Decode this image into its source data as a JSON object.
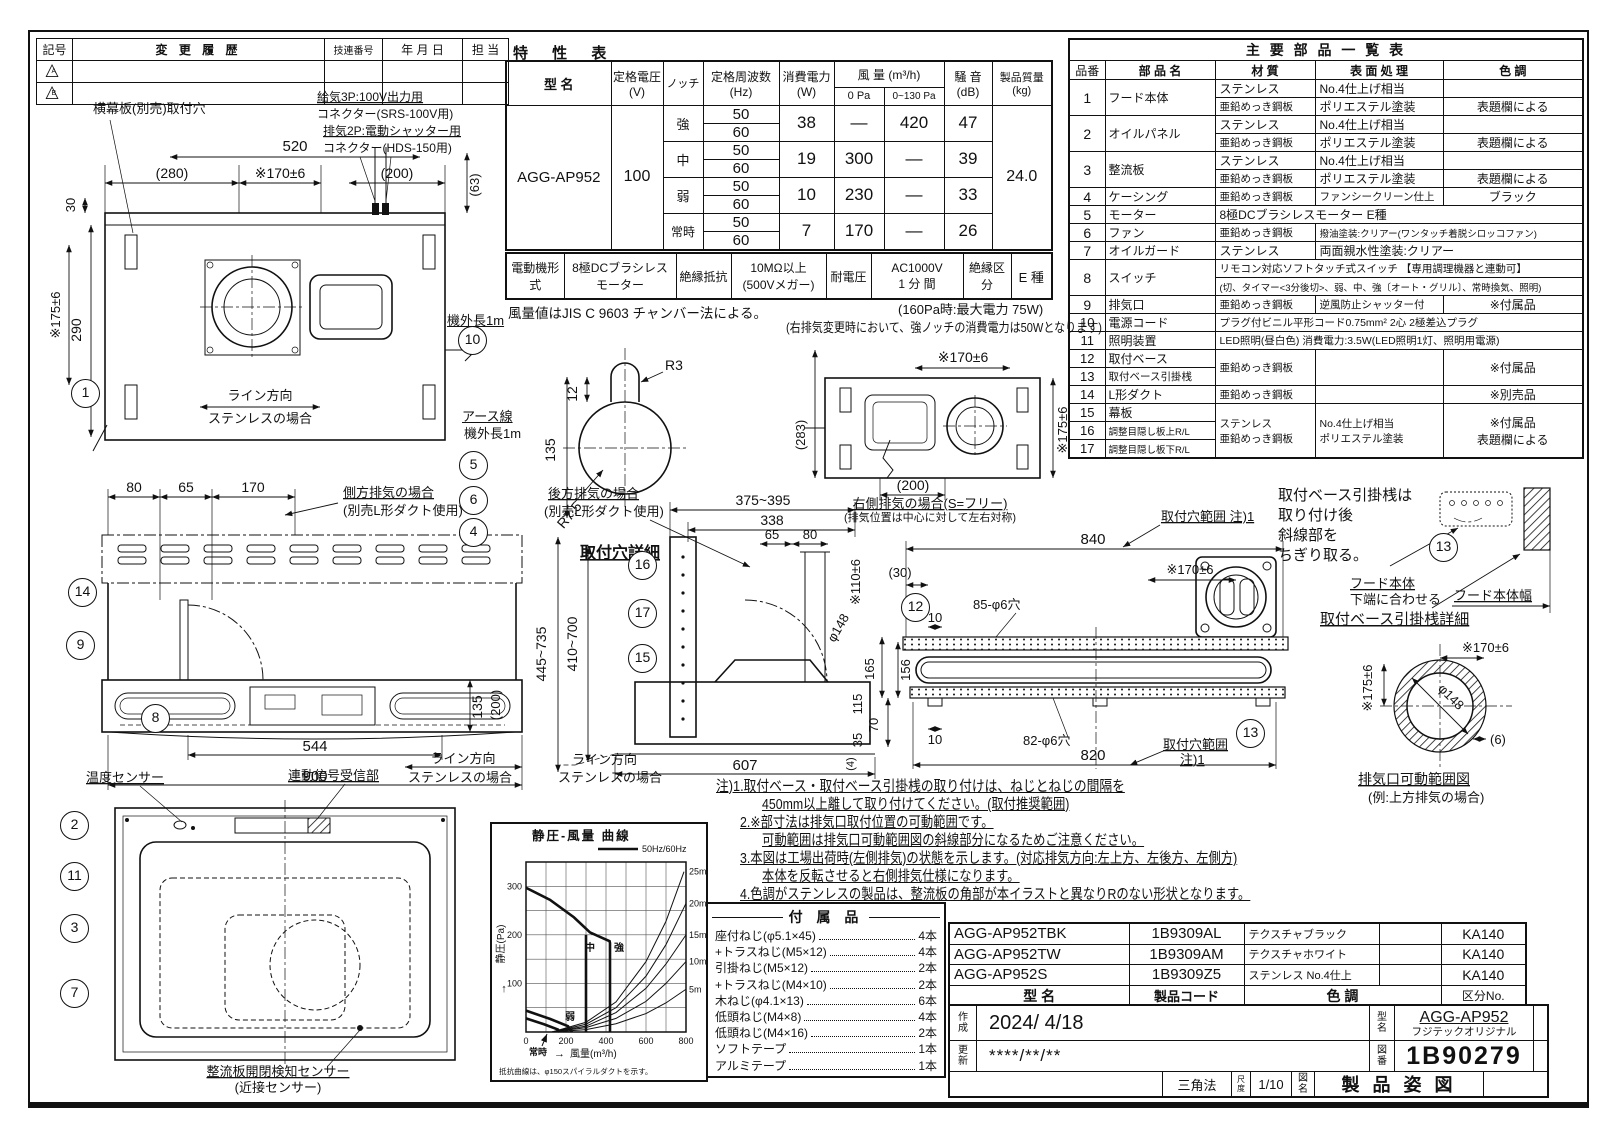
{
  "revision": {
    "headers": [
      "記号",
      "変 更 履 歴",
      "技連番号",
      "年 月 日",
      "担 当"
    ],
    "marks": [
      "A",
      "B"
    ]
  },
  "spec": {
    "title": "特   性   表",
    "h_model": "型   名",
    "h_voltage": "定格電圧\n(V)",
    "h_notch": "ノッチ",
    "h_freq": "定格周波数\n(Hz)",
    "h_power": "消費電力\n(W)",
    "h_airflow": "風 量 (m³/h)",
    "h_airflow_0": "0 Pa",
    "h_airflow_130": "0~130 Pa",
    "h_noise": "騒 音\n(dB)",
    "h_mass": "製品質量\n(kg)",
    "model": "AGG-AP952",
    "voltage": "100",
    "mass": "24.0",
    "rows": [
      {
        "notch": "強",
        "f1": "50",
        "f2": "60",
        "power": "38",
        "q0": "—",
        "q130": "420",
        "noise": "47"
      },
      {
        "notch": "中",
        "f1": "50",
        "f2": "60",
        "power": "19",
        "q0": "300",
        "q130": "—",
        "noise": "39"
      },
      {
        "notch": "弱",
        "f1": "50",
        "f2": "60",
        "power": "10",
        "q0": "230",
        "q130": "—",
        "noise": "33"
      },
      {
        "notch": "常時",
        "f1": "50",
        "f2": "60",
        "power": "7",
        "q0": "170",
        "q130": "—",
        "noise": "26"
      }
    ],
    "motor_row": [
      "電動機形式",
      "8極DCブラシレス\nモーター",
      "絶縁抵抗",
      "10MΩ以上\n(500Vメガー)",
      "耐電圧",
      "AC1000V\n1 分 間",
      "絶縁区分",
      "E 種"
    ],
    "note1": "風量値はJIS C 9603 チャンバー法による。",
    "note2": "(160Pa時:最大電力 75W)",
    "note3": "(右排気変更時において、強ノッチの消費電力は50Wとなります)"
  },
  "parts": {
    "title": "主  要  部  品  一  覧  表",
    "h": [
      "品番",
      "部 品 名",
      "材   質",
      "表 面 処 理",
      "色   調"
    ],
    "r1": {
      "no": "1",
      "name": "フード本体",
      "m1": "ステンレス",
      "t1": "No.4仕上げ相当",
      "c1": "",
      "m2": "亜鉛めっき鋼板",
      "t2": "ポリエステル塗装",
      "c2": "表題欄による"
    },
    "r2": {
      "no": "2",
      "name": "オイルパネル",
      "m1": "ステンレス",
      "t1": "No.4仕上げ相当",
      "c1": "",
      "m2": "亜鉛めっき鋼板",
      "t2": "ポリエステル塗装",
      "c2": "表題欄による"
    },
    "r3": {
      "no": "3",
      "name": "整流板",
      "m1": "ステンレス",
      "t1": "No.4仕上げ相当",
      "c1": "",
      "m2": "亜鉛めっき鋼板",
      "t2": "ポリエステル塗装",
      "c2": "表題欄による"
    },
    "r4": {
      "no": "4",
      "name": "ケーシング",
      "m": "亜鉛めっき鋼板",
      "t": "ファンシークリーン仕上",
      "c": "ブラック"
    },
    "r5": {
      "no": "5",
      "name": "モーター",
      "full": "8極DCブラシレスモーター E種"
    },
    "r6": {
      "no": "6",
      "name": "ファン",
      "m": "亜鉛めっき鋼板",
      "t": "撥油塗装:クリアー(ワンタッチ着脱シロッコファン)"
    },
    "r7": {
      "no": "7",
      "name": "オイルガード",
      "m": "ステンレス",
      "t": "両面親水性塗装:クリアー"
    },
    "r8": {
      "no": "8",
      "name": "スイッチ",
      "l1": "リモコン対応ソフトタッチ式スイッチ 【専用調理機器と連動可】",
      "l2": "(切、タイマー<3分後切>、弱、中、強〔オート・グリル〕、常時換気、照明)"
    },
    "r9": {
      "no": "9",
      "name": "排気口",
      "m": "亜鉛めっき鋼板",
      "t": "逆風防止シャッター付",
      "c": "※付属品"
    },
    "r10": {
      "no": "10",
      "name": "電源コード",
      "full": "プラグ付ビニル平形コード0.75mm² 2心 2極差込プラグ"
    },
    "r11": {
      "no": "11",
      "name": "照明装置",
      "full": "LED照明(昼白色) 消費電力:3.5W(LED照明1灯、照明用電源)"
    },
    "r12": {
      "no": "12",
      "name": "取付ベース"
    },
    "r13": {
      "no": "13",
      "name": "取付ベース引掛桟"
    },
    "g1213": {
      "m": "亜鉛めっき鋼板",
      "c": "※付属品"
    },
    "r14": {
      "no": "14",
      "name": "L形ダクト",
      "m": "亜鉛めっき鋼板",
      "c": "※別売品"
    },
    "r15": {
      "no": "15",
      "name": "幕板"
    },
    "r16": {
      "no": "16",
      "name": "調整目隠し板上R/L"
    },
    "r17": {
      "no": "17",
      "name": "調整目隠し板下R/L"
    },
    "g1517": {
      "m": "ステンレス\n亜鉛めっき鋼板",
      "t": "No.4仕上げ相当\nポリエステル塗装",
      "c": "※付属品\n表題欄による"
    }
  },
  "dw": {
    "top": {
      "hole_label": "横幕板(別売)取付穴",
      "conn1": "給気3P:100V出力用",
      "conn2": "コネクター(SRS-100V用)",
      "conn3": "排気2P:電動シャッター用",
      "conn4": "コネクター(HDS-150用)",
      "d520": "520",
      "d280": "(280)",
      "d170": "※170±6",
      "d200": "(200)",
      "d63": "(63)",
      "d30": "30",
      "d290": "290",
      "d175": "※175±6",
      "line1": "ライン方向",
      "line2": "ステンレスの場合",
      "cord": "機外長1m",
      "earth": "アース線",
      "earth_len": "機外長1m"
    },
    "keyhole": {
      "r3": "R3",
      "d12": "12",
      "d135": "135",
      "r75": "R7.5",
      "cap": "取付穴詳細"
    },
    "front": {
      "d80": "80",
      "d65": "65",
      "d170": "170",
      "side1": "側方排気の場合",
      "side2": "(別売L形ダクト使用)",
      "d544": "544",
      "d900": "900",
      "d135": "135",
      "d200": "(200)",
      "line1": "ライン方向",
      "line2": "ステンレスの場合"
    },
    "bottom": {
      "temp": "温度センサー",
      "recv": "連動信号受信部",
      "sens1": "整流板開閉検知センサー",
      "sens2": "(近接センサー)"
    },
    "side": {
      "rear1": "後方排気の場合",
      "rear2": "(別売L形ダクト使用)",
      "d375": "375~395",
      "d338": "338",
      "d65": "65",
      "d80": "80",
      "d110": "※110±6",
      "d148": "φ148",
      "d445": "445~735",
      "d410": "410~700",
      "d607": "607",
      "d115": "115",
      "d35": "35",
      "d4": "(4)",
      "line1": "ライン方向",
      "line2": "ステンレスの場合"
    },
    "rtop": {
      "d170": "※170±6",
      "d283": "(283)",
      "d200": "(200)",
      "d175": "※175±6",
      "cap1": "右側排気の場合(S=フリー)",
      "cap2": "(排気位置は中心に対して左右対称)"
    },
    "rbottom": {
      "range1": "取付穴範囲 注)1",
      "d840": "840",
      "d30": "(30)",
      "d170": "※170±6",
      "h85": "85-φ6穴",
      "d10a": "10",
      "d165": "165",
      "d156": "156",
      "d70": "70",
      "d10b": "10",
      "h82": "82-φ6穴",
      "d820": "820",
      "range2": "取付穴範囲",
      "range3": "注)1"
    },
    "detail": {
      "n1": "取付ベース引掛桟は",
      "n2": "取り付け後",
      "n3": "斜線部を",
      "n4": "ちぎり取る。",
      "hood1": "フード本体",
      "hood2": "下端に合わせる",
      "hoodw": "フード本体幅",
      "cap": "取付ベース引掛桟詳細",
      "d175": "※175±6",
      "d170": "※170±6",
      "d148": "φ148",
      "d6": "(6)",
      "cap2": "排気口可動範囲図",
      "cap3": "(例:上方排気の場合)"
    }
  },
  "notes": {
    "l1": "注)1.取付ベース・取付ベース引掛桟の取り付けは、ねじとねじの間隔を",
    "l2": "450mm以上離して取り付けてください。(取付推奨範囲)",
    "l3": "2.※部寸法は排気口取付位置の可動範囲です。",
    "l4": "可動範囲は排気口可動範囲図の斜線部分になるためご注意ください。",
    "l5": "3.本図は工場出荷時(左側排気)の状態を示します。(対応排気方向:左上方、左後方、左側方)",
    "l6": "本体を反転させると右側排気仕様になります。",
    "l7": "4.色調がステンレスの製品は、整流板の角部が本イラストと異なりRのない形状となります。"
  },
  "chart_data": {
    "type": "line",
    "title": "静圧-風量 曲線",
    "legend_label": "50Hz/60Hz",
    "xlabel": "風量(m³/h)",
    "ylabel": "静圧(Pa)",
    "x_axis_arrow": "→",
    "y_axis_arrow": "↑",
    "xlim": [
      0,
      800
    ],
    "ylim": [
      0,
      350
    ],
    "xticks": [
      0,
      200,
      400,
      600,
      800
    ],
    "yticks": [
      100,
      200,
      300
    ],
    "grid_step_x": 100,
    "grid_step_y": 50,
    "curve_labels": {
      "strong": "強",
      "mid": "中",
      "weak": "弱",
      "constant": "常時"
    },
    "series": [
      {
        "name": "fan-curve-strong",
        "points": [
          [
            0,
            297
          ],
          [
            120,
            272
          ],
          [
            240,
            236
          ],
          [
            320,
            205
          ],
          [
            390,
            192
          ],
          [
            418,
            187
          ],
          [
            420,
            183
          ],
          [
            420,
            0
          ]
        ]
      },
      {
        "name": "fan-curve-mid",
        "points": [
          [
            300,
            200
          ],
          [
            300,
            0
          ]
        ]
      },
      {
        "name": "fan-curve-weak",
        "points": [
          [
            0,
            44
          ],
          [
            120,
            27
          ],
          [
            210,
            12
          ],
          [
            230,
            0
          ]
        ]
      },
      {
        "name": "fan-curve-constant",
        "points": [
          [
            0,
            28
          ],
          [
            90,
            16
          ],
          [
            160,
            5
          ],
          [
            168,
            0
          ]
        ]
      }
    ],
    "duct_resistance_curves": [
      {
        "name": "25m",
        "points": [
          [
            130,
            0
          ],
          [
            300,
            20
          ],
          [
            450,
            62
          ],
          [
            600,
            145
          ],
          [
            700,
            228
          ],
          [
            790,
            330
          ]
        ]
      },
      {
        "name": "20m",
        "points": [
          [
            130,
            0
          ],
          [
            300,
            16
          ],
          [
            450,
            50
          ],
          [
            600,
            115
          ],
          [
            700,
            180
          ],
          [
            800,
            265
          ]
        ]
      },
      {
        "name": "15m",
        "points": [
          [
            130,
            0
          ],
          [
            300,
            12
          ],
          [
            450,
            40
          ],
          [
            600,
            90
          ],
          [
            700,
            140
          ],
          [
            800,
            200
          ]
        ]
      },
      {
        "name": "10m",
        "points": [
          [
            130,
            0
          ],
          [
            300,
            9
          ],
          [
            450,
            28
          ],
          [
            600,
            63
          ],
          [
            700,
            100
          ],
          [
            800,
            145
          ]
        ]
      },
      {
        "name": "5m",
        "points": [
          [
            130,
            0
          ],
          [
            300,
            5
          ],
          [
            450,
            17
          ],
          [
            600,
            38
          ],
          [
            700,
            60
          ],
          [
            800,
            88
          ]
        ]
      }
    ],
    "footnote": "抵抗曲線は、φ150スパイラルダクトを示す。"
  },
  "accessories": {
    "title": "付 属 品",
    "items": [
      {
        "n": "座付ねじ(φ5.1×45)",
        "q": "4本"
      },
      {
        "n": "+トラスねじ(M5×12)",
        "q": "4本"
      },
      {
        "n": "引掛ねじ(M5×12)",
        "q": "2本"
      },
      {
        "n": "+トラスねじ(M4×10)",
        "q": "2本"
      },
      {
        "n": "木ねじ(φ4.1×13)",
        "q": "6本"
      },
      {
        "n": "低頭ねじ(M4×8)",
        "q": "4本"
      },
      {
        "n": "低頭ねじ(M4×16)",
        "q": "2本"
      },
      {
        "n": "ソフトテープ",
        "q": "1本"
      },
      {
        "n": "アルミテープ",
        "q": "1本"
      }
    ]
  },
  "variants": {
    "rows": [
      [
        "AGG-AP952TBK",
        "1B9309AL",
        "テクスチャブラック",
        "",
        "KA140"
      ],
      [
        "AGG-AP952TW",
        "1B9309AM",
        "テクスチャホワイト",
        "",
        "KA140"
      ],
      [
        "AGG-AP952S",
        "1B9309Z5",
        "ステンレス No.4仕上",
        "",
        "KA140"
      ]
    ],
    "h": [
      "型   名",
      "製品コード",
      "色   調",
      "区分No."
    ]
  },
  "titleblock": {
    "created_l": "作\n成",
    "created": "2024/ 4/18",
    "updated_l": "更\n新",
    "updated": "****/**/**",
    "model_l": "型\n名",
    "model": "AGG-AP952",
    "brand": "フジテックオリジナル",
    "no_l": "図\n番",
    "no": "1B90279",
    "angle": "三角法",
    "scale_l": "尺\n度",
    "scale": "1/10",
    "name_l": "図\n名",
    "name": "製 品 姿 図"
  },
  "balloons": [
    "1",
    "2",
    "3",
    "4",
    "5",
    "6",
    "7",
    "8",
    "9",
    "10",
    "11",
    "12",
    "13",
    "14",
    "15",
    "16",
    "17"
  ]
}
